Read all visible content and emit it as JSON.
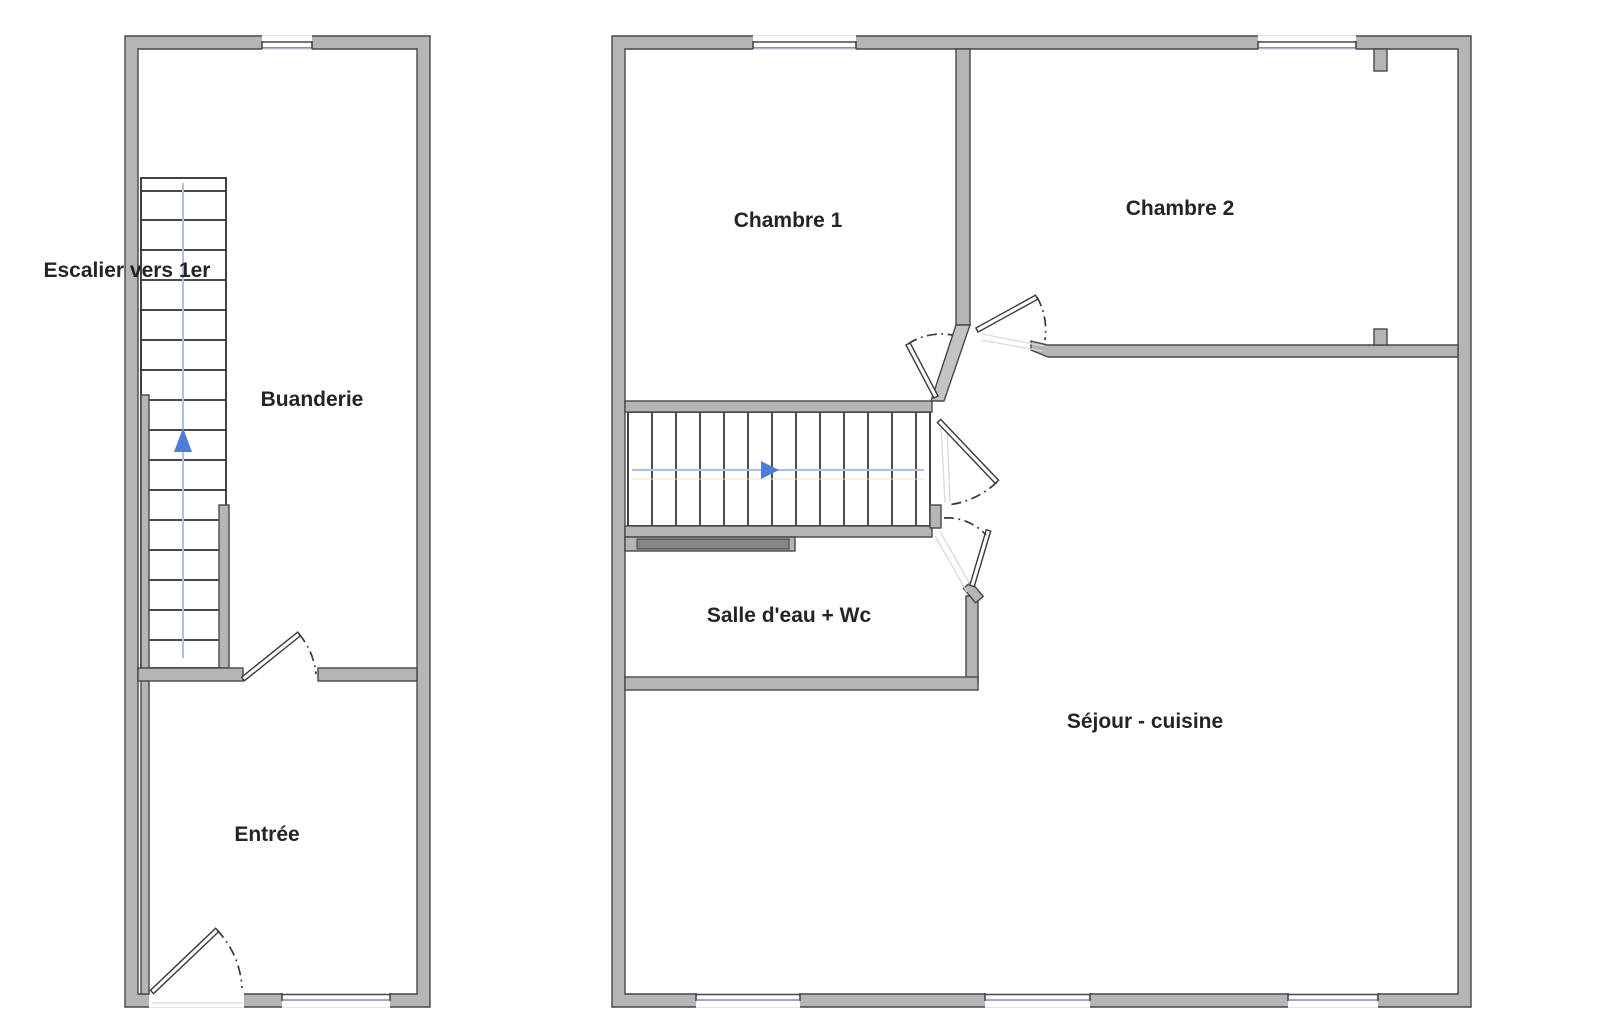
{
  "plans": {
    "ground_floor": {
      "name": "Rez-de-chaussée",
      "rooms": [
        {
          "label": "Escalier vers 1er"
        },
        {
          "label": "Buanderie"
        },
        {
          "label": "Entrée"
        }
      ]
    },
    "first_floor": {
      "name": "1er étage",
      "rooms": [
        {
          "label": "Chambre 1"
        },
        {
          "label": "Chambre 2"
        },
        {
          "label": "Salle d'eau + Wc"
        },
        {
          "label": "Séjour - cuisine"
        }
      ]
    }
  },
  "colors": {
    "wall_fill": "#b5b5b7",
    "wall_outline": "#47474a",
    "diagonal_wall_fill": "#c4c4c6",
    "low_wall_fill": "#86868a",
    "window_glass": "#8a8abb",
    "stair_tread": "#2e2e2e",
    "stair_direction_line": "#a9c0e8",
    "stair_secondary_line": "#e9e0c2",
    "stair_direction_arrow": "#4c7ed8",
    "door_swing": "#3a3a3c",
    "door_leaf_fill": "#fbfbfb",
    "label_text": "#242424"
  },
  "icons": {
    "stairs_up_arrow": "triangle-up",
    "stairs_forward_arrow": "triangle-right"
  }
}
